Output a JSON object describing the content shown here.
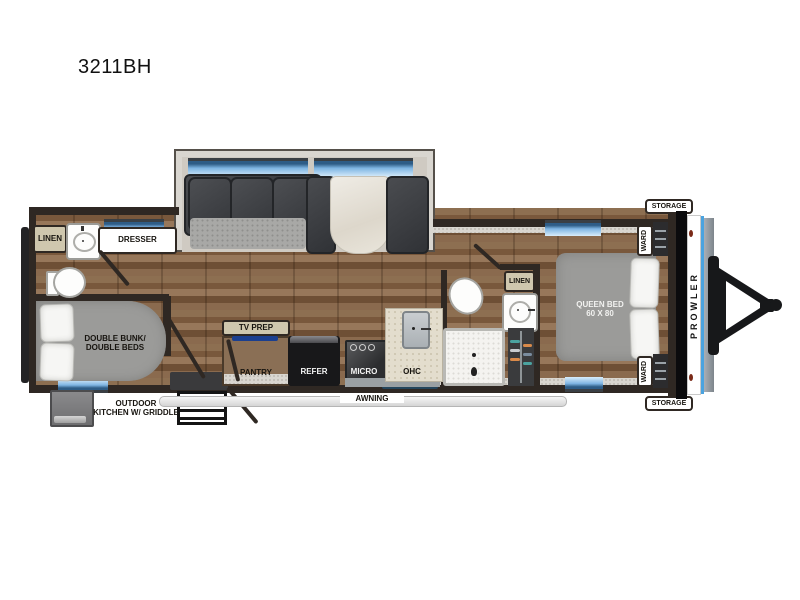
{
  "title": "3211BH",
  "brand": "PROWLER",
  "colors": {
    "floor_wood": "#856648",
    "wall_dark": "#2f2823",
    "window_blue": "#7fb5e3",
    "pinstripe_blue": "#4aa3e0",
    "label_beige": "#cfc7ae",
    "appliance_black": "#1a1a1c",
    "mattress_gray": "#9b9b99",
    "tv_accent_blue": "#1b3f8f"
  },
  "rooms": {
    "rear_bath": {
      "linen": "LINEN",
      "dresser": "DRESSER"
    },
    "bunk_room": {
      "bed_line1": "DOUBLE BUNK/",
      "bed_line2": "DOUBLE BEDS",
      "outdoor_line1": "OUTDOOR",
      "outdoor_line2": "KITCHEN W/ GRIDDLE"
    },
    "kitchen": {
      "tv_prep": "TV PREP",
      "pantry": "PANTRY",
      "refer": "REFER",
      "micro": "MICRO",
      "ohc": "OHC"
    },
    "mid_bath": {
      "linen": "LINEN"
    },
    "bedroom": {
      "bed_line1": "QUEEN BED",
      "bed_line2": "60 X 80",
      "ward_top": "WARD",
      "ward_bottom": "WARD"
    },
    "exterior": {
      "awning": "AWNING",
      "storage_top": "STORAGE",
      "storage_bottom": "STORAGE"
    }
  }
}
